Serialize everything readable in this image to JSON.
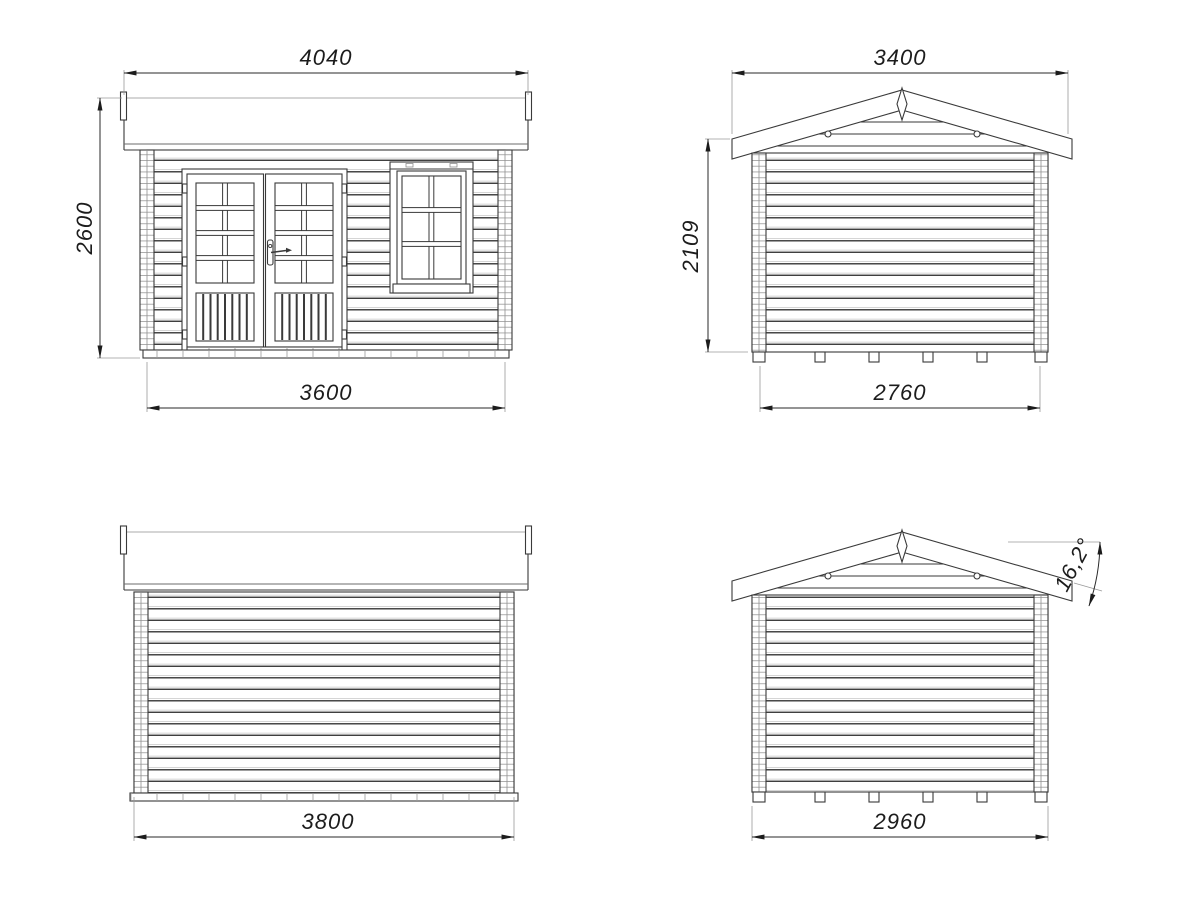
{
  "drawing": {
    "type": "technical-elevation-drawing",
    "subject": "log cabin garden house - four elevation views",
    "units": "mm",
    "colors": {
      "background": "#ffffff",
      "line": "#3a3a3a",
      "dimension_text": "#1c1c1c",
      "extension_line": "#9a9a9a"
    },
    "views": {
      "front": {
        "label": "front elevation",
        "dim_roof_width": "4040",
        "dim_height": "2600",
        "dim_wall_width": "3600"
      },
      "side_a": {
        "label": "side elevation (gable)",
        "dim_roof_width": "3400",
        "dim_wall_height": "2109",
        "dim_wall_width": "2760"
      },
      "back": {
        "label": "rear elevation",
        "dim_wall_width": "3800"
      },
      "side_b": {
        "label": "side elevation (gable) with roof pitch",
        "dim_wall_width": "2960",
        "dim_roof_angle": "16,2°"
      }
    }
  }
}
